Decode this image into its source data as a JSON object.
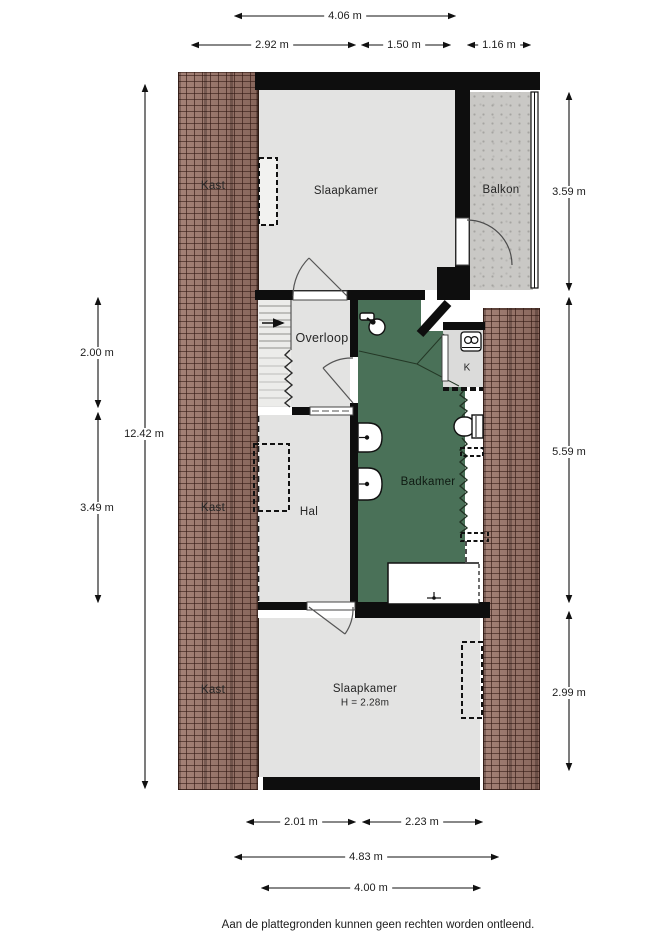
{
  "plan": {
    "footer": "Aan de plattegronden kunnen geen rechten worden ontleend.",
    "rooms": {
      "kast_top": {
        "label": "Kast"
      },
      "slaapkamer_top": {
        "label": "Slaapkamer"
      },
      "balkon": {
        "label": "Balkon"
      },
      "overloop": {
        "label": "Overloop"
      },
      "k": {
        "label": "K"
      },
      "hal": {
        "label": "Hal"
      },
      "badkamer": {
        "label": "Badkamer"
      },
      "kast_mid": {
        "label": "Kast"
      },
      "slaapkamer_bottom": {
        "label": "Slaapkamer",
        "height": "H = 2.28m"
      },
      "kast_bottom": {
        "label": "Kast"
      }
    },
    "dimensions": {
      "top": [
        {
          "label": "4.06 m"
        },
        {
          "label": "2.92 m"
        },
        {
          "label": "1.50 m"
        },
        {
          "label": "1.16 m"
        }
      ],
      "left": [
        {
          "label": "2.00 m"
        },
        {
          "label": "12.42 m"
        },
        {
          "label": "3.49 m"
        }
      ],
      "right": [
        {
          "label": "3.59 m"
        },
        {
          "label": "5.59 m"
        },
        {
          "label": "2.99 m"
        }
      ],
      "bottom": [
        {
          "label": "2.01 m"
        },
        {
          "label": "2.23 m"
        },
        {
          "label": "4.83 m"
        },
        {
          "label": "4.00 m"
        }
      ]
    },
    "colors": {
      "wall": "#0e0e0e",
      "room_gray": "#e3e3e2",
      "badkamer_green": "#4a7158",
      "balkon_gray": "#c9c8c5",
      "roof_brown": "#9a7468"
    }
  }
}
